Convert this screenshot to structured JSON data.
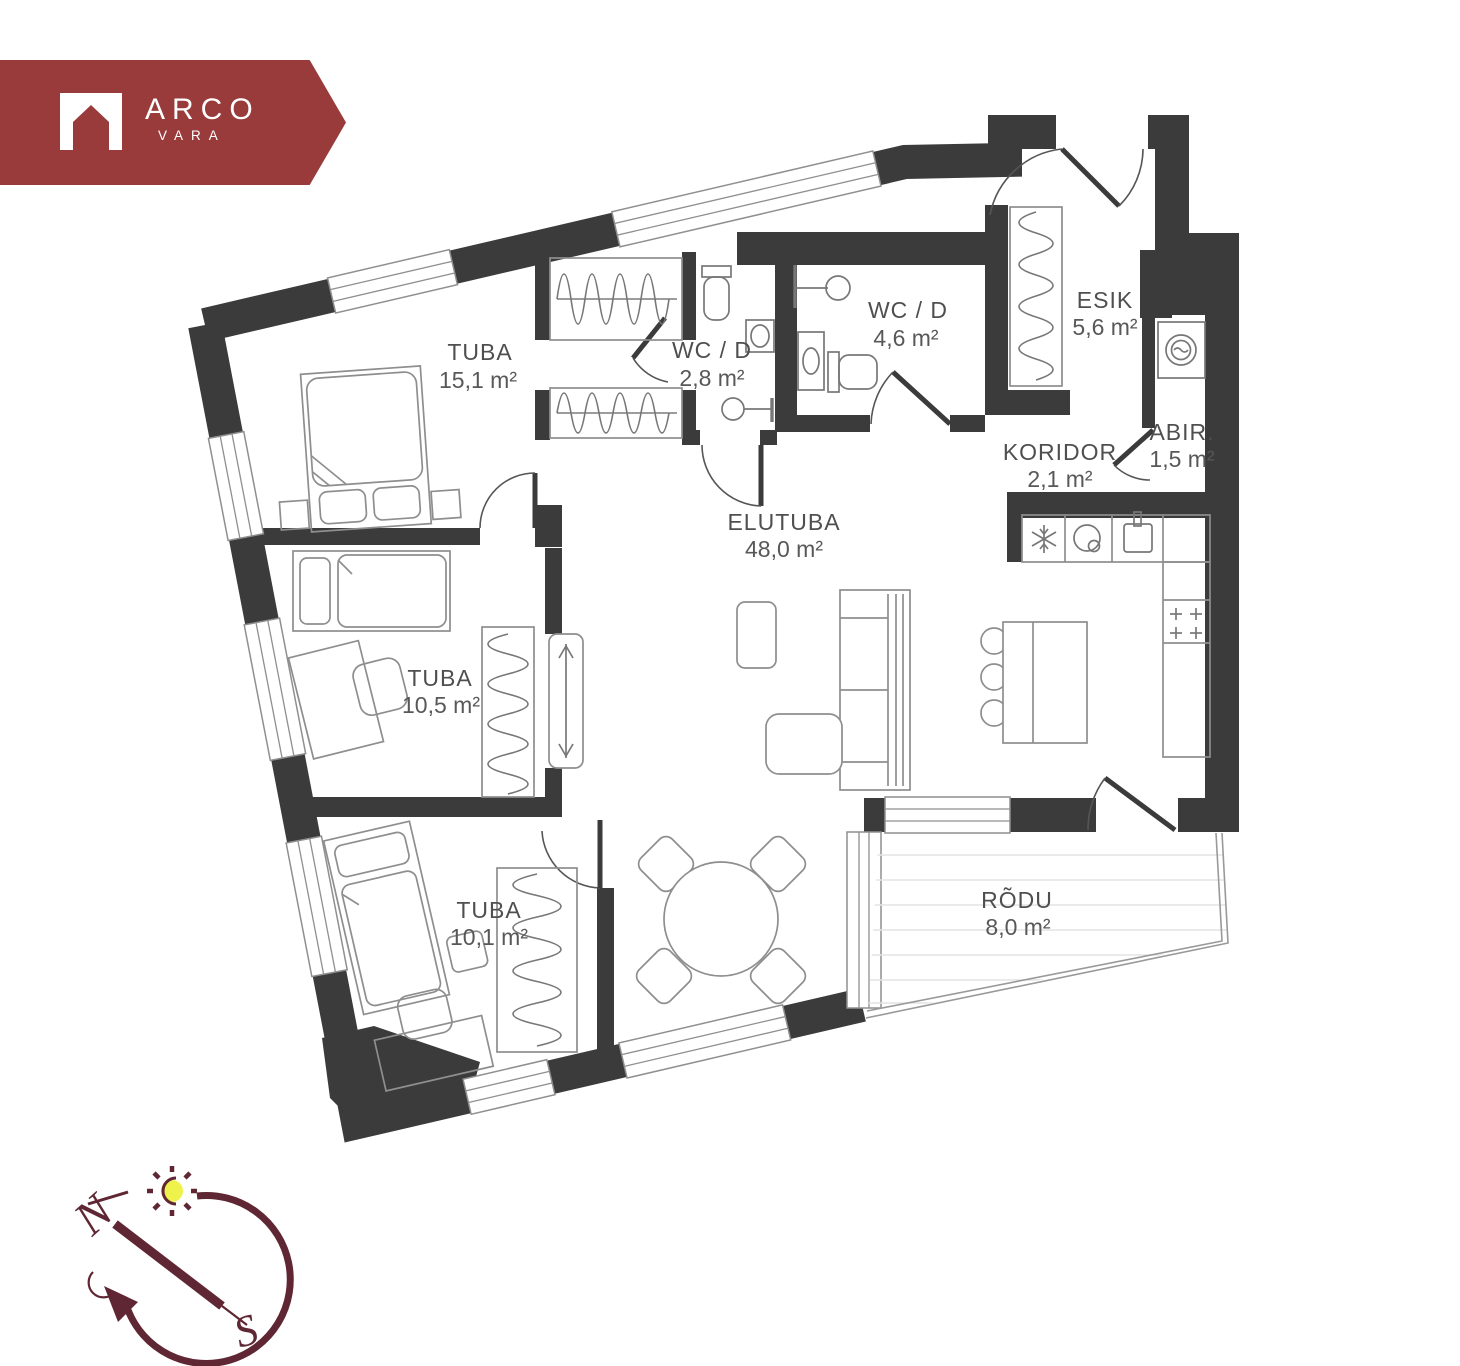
{
  "logo": {
    "brand": "ARCO",
    "sub": "VARA"
  },
  "rooms": [
    {
      "id": "tuba-151",
      "name": "TUBA",
      "area": "15,1 m²"
    },
    {
      "id": "wc-28",
      "name": "WC / D",
      "area": "2,8 m²"
    },
    {
      "id": "wc-46",
      "name": "WC / D",
      "area": "4,6 m²"
    },
    {
      "id": "esik",
      "name": "ESIK",
      "area": "5,6 m²"
    },
    {
      "id": "koridor",
      "name": "KORIDOR",
      "area": "2,1 m²"
    },
    {
      "id": "abir",
      "name": "ABIR.",
      "area": "1,5 m²"
    },
    {
      "id": "elutuba",
      "name": "ELUTUBA",
      "area": "48,0 m²"
    },
    {
      "id": "tuba-105",
      "name": "TUBA",
      "area": "10,5 m²"
    },
    {
      "id": "tuba-101",
      "name": "TUBA",
      "area": "10,1 m²"
    },
    {
      "id": "rodu",
      "name": "RÕDU",
      "area": "8,0 m²"
    }
  ],
  "compass": {
    "north": "N",
    "south": "S"
  },
  "colors": {
    "brand_red": "#993b3b",
    "wall": "#3b3b3b",
    "compass_maroon": "#5f2733",
    "sun_yellow": "#eef24b"
  },
  "icons": {
    "logo": "house-icon",
    "kitchen": [
      "snowflake-icon",
      "dishwasher-icon",
      "sink-icon",
      "stove-icon"
    ],
    "utility": "washing-machine-icon",
    "compass": [
      "sun-icon",
      "moon-icon"
    ]
  }
}
